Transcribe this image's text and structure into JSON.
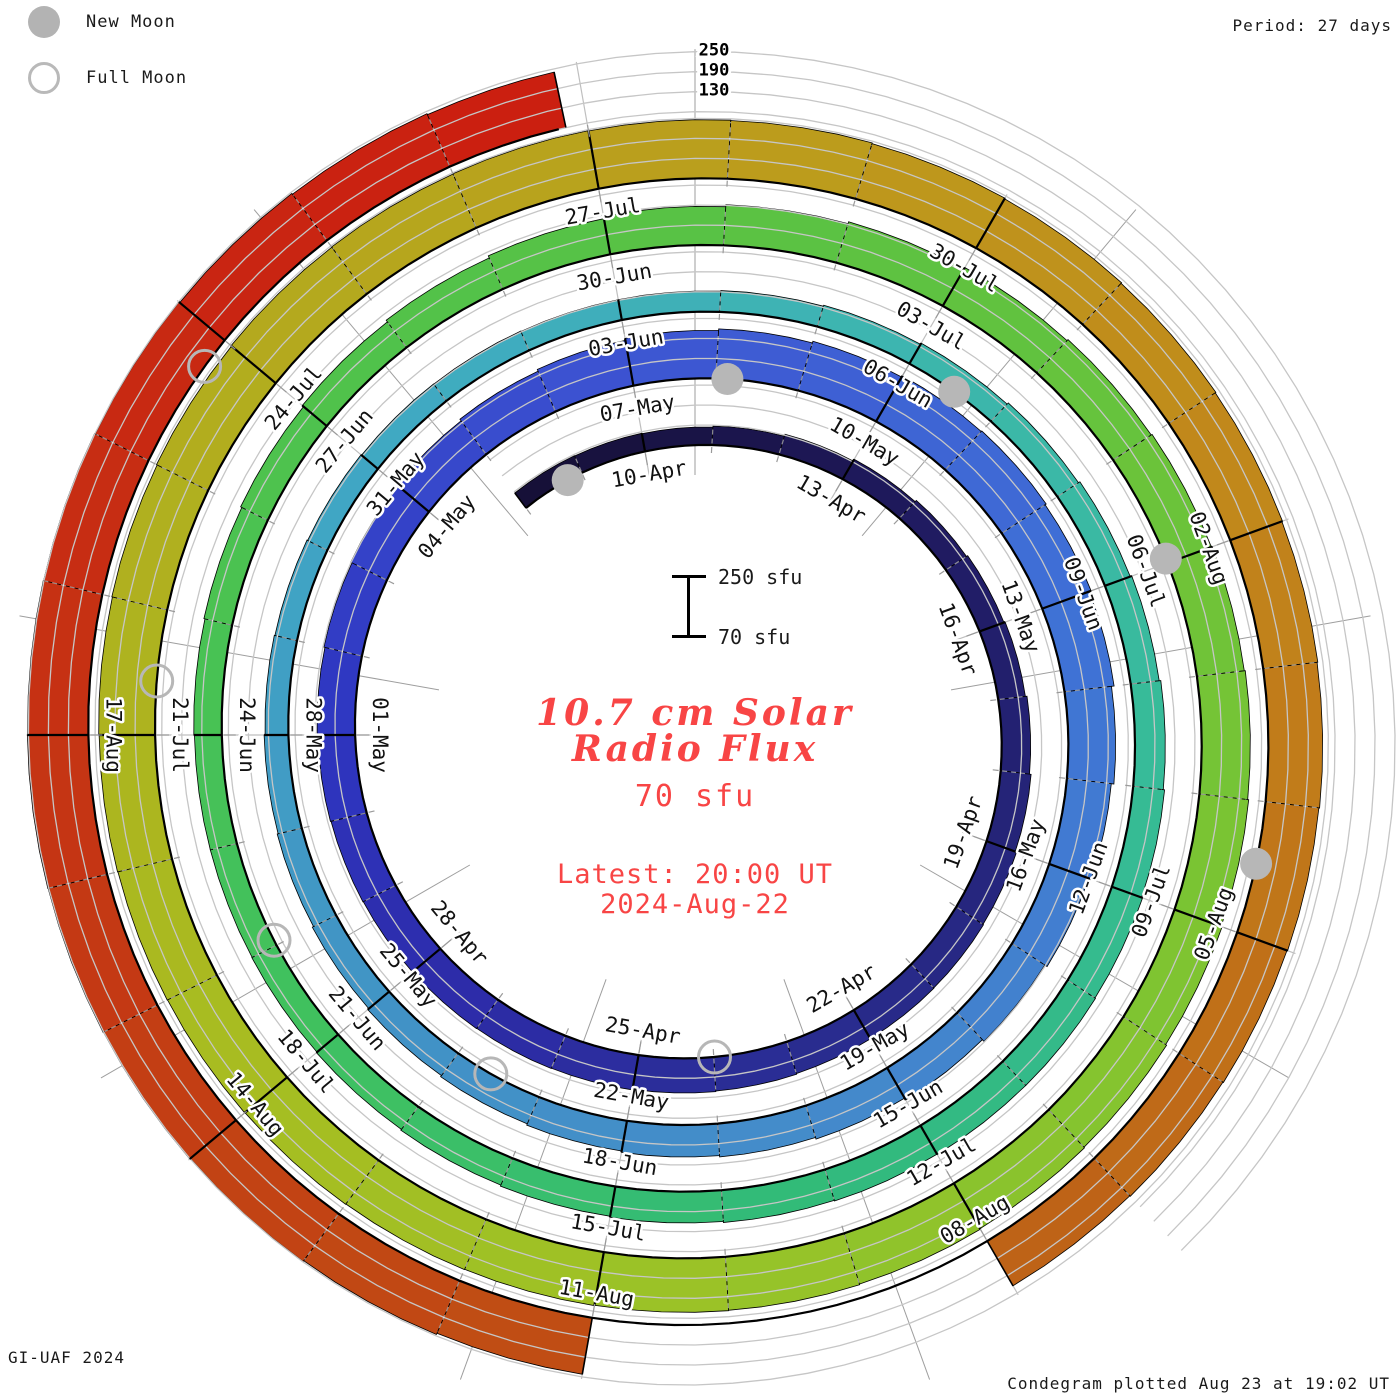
{
  "page_title": "10.7 cm Solar Radio Flux Condegram",
  "legend": {
    "new_moon_label": "New Moon",
    "full_moon_label": "Full Moon",
    "moon_gray": "#b3b3b3"
  },
  "header": {
    "period_label": "Period: 27 days"
  },
  "footer": {
    "credit": "GI-UAF 2024",
    "plotted": "Condegram plotted Aug 23 at 19:02 UT"
  },
  "center_annotation": {
    "scale_top_label": "250 sfu",
    "scale_bottom_label": "70 sfu",
    "title_line1": "10.7 cm Solar",
    "title_line2": "Radio Flux",
    "current_value": "70 sfu",
    "latest_line1": "Latest: 20:00 UT",
    "latest_line2": "2024-Aug-22",
    "accent_color": "#f84545"
  },
  "chart_data": {
    "type": "bar",
    "variant": "condegram-spiral",
    "title": "10.7 cm Solar Radio Flux",
    "units": "sfu",
    "period_days": 27,
    "baseline_sfu": 70,
    "ylim": [
      70,
      250
    ],
    "gridline_values_sfu": [
      130,
      190,
      250
    ],
    "radial_axis_tick_labels": [
      "250",
      "190",
      "130"
    ],
    "start_date": "2024-04-08",
    "end_date": "2024-08-22",
    "missing_dates": [
      "2024-08-08",
      "2024-08-09",
      "2024-08-10"
    ],
    "start_t_days_from_apr10": -2,
    "last_day_fraction": 0.85,
    "values_sfu": [
      126,
      125,
      124,
      127,
      133,
      139,
      144,
      148,
      152,
      157,
      162,
      166,
      168,
      169,
      170,
      172,
      174,
      176,
      177,
      178,
      179,
      180,
      182,
      184,
      187,
      191,
      196,
      202,
      208,
      214,
      219,
      224,
      228,
      230,
      226,
      220,
      212,
      204,
      196,
      188,
      181,
      175,
      170,
      166,
      162,
      158,
      154,
      150,
      146,
      143,
      140,
      138,
      136,
      134,
      133,
      132,
      132,
      134,
      137,
      141,
      146,
      151,
      156,
      161,
      165,
      168,
      170,
      170,
      169,
      167,
      164,
      161,
      158,
      155,
      153,
      152,
      152,
      154,
      157,
      161,
      166,
      172,
      179,
      186,
      192,
      198,
      203,
      207,
      210,
      213,
      216,
      219,
      222,
      225,
      227,
      229,
      231,
      232,
      233,
      234,
      235,
      236,
      237,
      238,
      239,
      241,
      243,
      245,
      246,
      247,
      246,
      245,
      243,
      241,
      239,
      237,
      235,
      233,
      231,
      229,
      227,
      225,
      null,
      null,
      null,
      242,
      246,
      249,
      251,
      252,
      253,
      252,
      251,
      249,
      246,
      243,
      240
    ],
    "date_label_step_days": 3,
    "date_labels": [
      "10-Apr",
      "13-Apr",
      "16-Apr",
      "19-Apr",
      "22-Apr",
      "25-Apr",
      "28-Apr",
      "01-May",
      "04-May",
      "07-May",
      "10-May",
      "13-May",
      "16-May",
      "19-May",
      "22-May",
      "25-May",
      "28-May",
      "31-May",
      "03-Jun",
      "06-Jun",
      "09-Jun",
      "12-Jun",
      "15-Jun",
      "18-Jun",
      "21-Jun",
      "24-Jun",
      "27-Jun",
      "30-Jun",
      "03-Jul",
      "06-Jul",
      "09-Jul",
      "12-Jul",
      "15-Jul",
      "18-Jul",
      "21-Jul",
      "24-Jul",
      "27-Jul",
      "30-Jul",
      "02-Aug",
      "05-Aug",
      "08-Aug",
      "11-Aug",
      "14-Aug",
      "17-Aug"
    ],
    "moons": [
      {
        "date": "2024-04-08",
        "phase": "new",
        "t": -1.24
      },
      {
        "date": "2024-04-23",
        "phase": "full",
        "t": 13.99
      },
      {
        "date": "2024-05-08",
        "phase": "new",
        "t": 28.14
      },
      {
        "date": "2024-05-23",
        "phase": "full",
        "t": 43.58
      },
      {
        "date": "2024-06-06",
        "phase": "new",
        "t": 57.53
      },
      {
        "date": "2024-06-22",
        "phase": "full",
        "t": 73.05
      },
      {
        "date": "2024-07-05",
        "phase": "new",
        "t": 86.96
      },
      {
        "date": "2024-07-21",
        "phase": "full",
        "t": 102.43
      },
      {
        "date": "2024-08-04",
        "phase": "new",
        "t": 116.47
      },
      {
        "date": "2024-08-19",
        "phase": "full",
        "t": 131.77
      }
    ],
    "color_stops": [
      [
        -2,
        "#150f35"
      ],
      [
        4,
        "#1f1a5e"
      ],
      [
        13,
        "#2a2d92"
      ],
      [
        18,
        "#2d2cab"
      ],
      [
        21,
        "#2e35c0"
      ],
      [
        27,
        "#3d55d2"
      ],
      [
        33,
        "#3f70d6"
      ],
      [
        40,
        "#448bca"
      ],
      [
        45,
        "#4193c5"
      ],
      [
        51,
        "#40a8c4"
      ],
      [
        56,
        "#3eb4b2"
      ],
      [
        61,
        "#38bb9c"
      ],
      [
        67,
        "#31ba7b"
      ],
      [
        72,
        "#3fc160"
      ],
      [
        78,
        "#4fc24c"
      ],
      [
        84,
        "#5fc240"
      ],
      [
        90,
        "#7cc432"
      ],
      [
        96,
        "#9ec226"
      ],
      [
        100,
        "#a9bb20"
      ],
      [
        105,
        "#b3ab1e"
      ],
      [
        110,
        "#bd9a1c"
      ],
      [
        114,
        "#c1851b"
      ],
      [
        118,
        "#c06d18"
      ],
      [
        120,
        "#bd5f16"
      ],
      [
        124,
        "#c04a14"
      ],
      [
        128,
        "#c43714"
      ],
      [
        132,
        "#c92712"
      ],
      [
        135,
        "#cb1d10"
      ]
    ],
    "grid_color": "#c6c6c6",
    "radial_line_color": "#bfbfbf",
    "baseline_color": "#000000",
    "geometry": {
      "cx": 695,
      "cy": 735,
      "r0_px": 288,
      "px_per_day": 2.47,
      "px_per_sfu": 0.3333,
      "deg_per_day": 13.33333,
      "start_angle_offset_deg": -10,
      "clockwise": true,
      "grid_t_max": 146
    }
  }
}
